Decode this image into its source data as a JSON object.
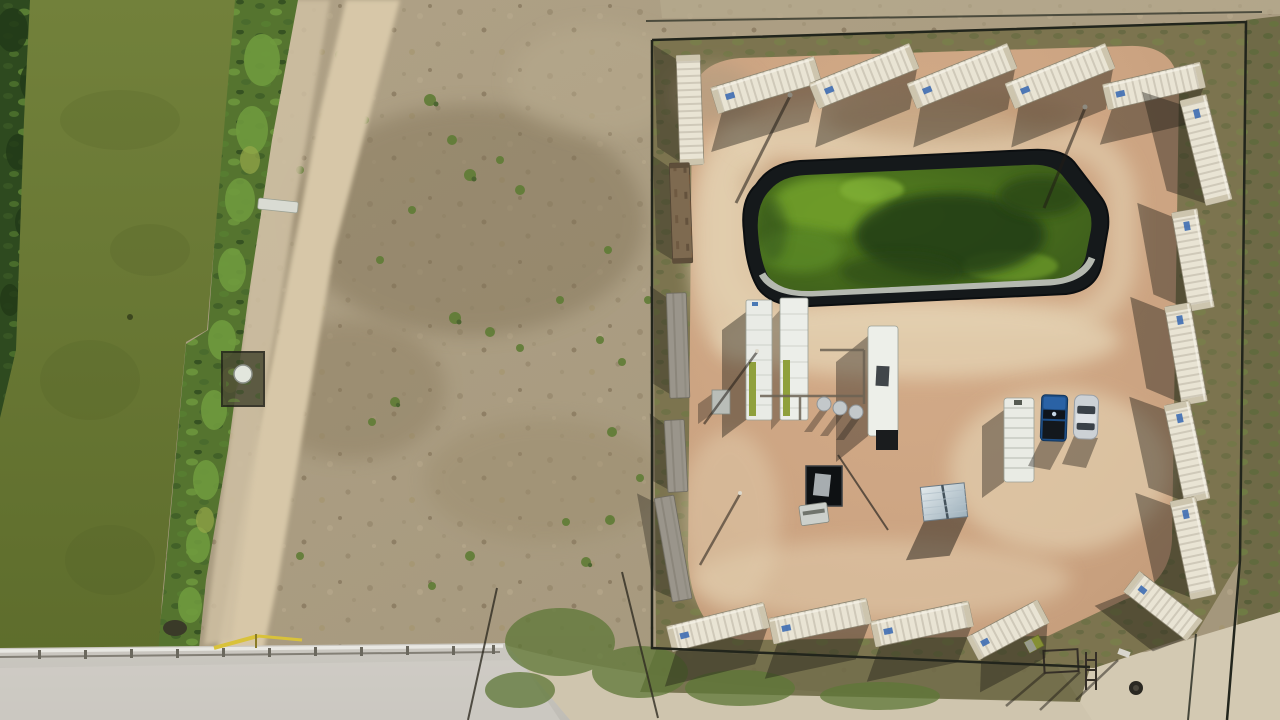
{
  "meta": {
    "type": "aerial-drone-photograph",
    "subject": "Top-down drone photo of a fenced oil and gas well pad ringed by white shipping containers, with a black-lined green retention pond, white equipment trailers, a pickup truck and a car, beside an algae-covered irrigation canal, scrub field, dirt roads and a concrete canal bridge",
    "orientation": "top-down, shadows falling toward lower-left"
  },
  "scene": {
    "areas": [
      {
        "name": "irrigation-canal",
        "desc": "wide algae-green canal running down the left edge, reed banks on both sides"
      },
      {
        "name": "scrub-field",
        "desc": "bare tan scrub field with sparse green shrubs and a diagonal dirt road"
      },
      {
        "name": "well-pad",
        "desc": "fenced pinkish caliche pad occupying the right half"
      },
      {
        "name": "retention-pond",
        "desc": "black-lined pond of green water at the top of the pad"
      },
      {
        "name": "canal-bridge",
        "desc": "concrete road bridge with guardrail crossing the canal at bottom left"
      }
    ],
    "counts": {
      "shipping_containers": 20,
      "white_containers": 16,
      "rusty_containers": 1,
      "weathered_containers": 3,
      "vehicles": 2,
      "ponds": 1,
      "light_poles": 4
    },
    "vehicles": [
      {
        "name": "pickup-truck",
        "color_name": "dark blue"
      },
      {
        "name": "sedan",
        "color_name": "silver"
      }
    ]
  },
  "palette": {
    "field_scrub": "#ab9d83",
    "field_patch": "#84765a",
    "canal_water": "#6d7b31",
    "reeds": "#55742f",
    "reeds_bright": "#6f9a3e",
    "trees_dark": "#2e4a1f",
    "dirt_road": "#d7c7a8",
    "pad_dirt": "#cba381",
    "pad_dirt_light": "#e4d2b2",
    "grass_border": "#7c744f",
    "pond_liner": "#15191b",
    "pond_water": "#476722",
    "pond_algae_bright": "#6f9e2c",
    "pond_algae_dark": "#233c13",
    "pond_lining_silver": "#c6cbc1",
    "container_white": "#e9e4d4",
    "container_rust": "#7e6a50",
    "container_weathered": "#9a958b",
    "shadow": "#201c16",
    "road_concrete": "#c7c4bd",
    "truck_blue": "#1d4e86",
    "car_silver": "#ccd1d5",
    "label_blue": "#3e6db3",
    "metal_shed": "#cdd6da",
    "tank_green": "#8fa03c",
    "gate_yellow": "#d9c23a"
  }
}
